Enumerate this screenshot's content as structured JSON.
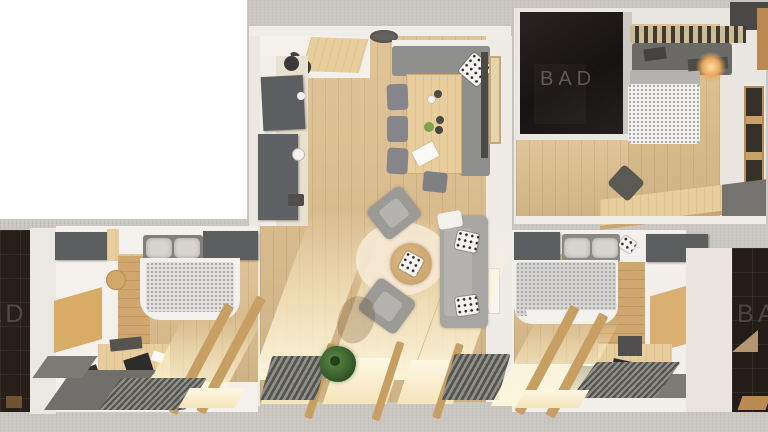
{
  "scene": {
    "title": "Top-down 3D rendering of an apartment floor plan",
    "labels": {
      "bath_top": "BAD",
      "bath_left": "BAD",
      "bath_right": "BAD"
    },
    "rooms": [
      "living-room-with-kitchen",
      "bathroom-top-right",
      "bedroom-top-right",
      "bedroom-bottom-left",
      "bathroom-far-left",
      "bedroom-bottom-right",
      "bathroom-far-right"
    ],
    "palette": {
      "background_wall_gray": "#cac6c1",
      "blank_area_white": "#ffffff",
      "wood_floor": "#ddbe8c",
      "dark_bathroom": "#1b1614",
      "bad_label_text": "#5a5551",
      "cabinet_gray": "#5d5e60",
      "sofa_gray": "#a7a6a3",
      "wall_white": "#ebe7e1",
      "sunlight": "#fdf4da",
      "plant_green": "#4e7a3a",
      "lamp_glow": "#e8a85c"
    }
  }
}
